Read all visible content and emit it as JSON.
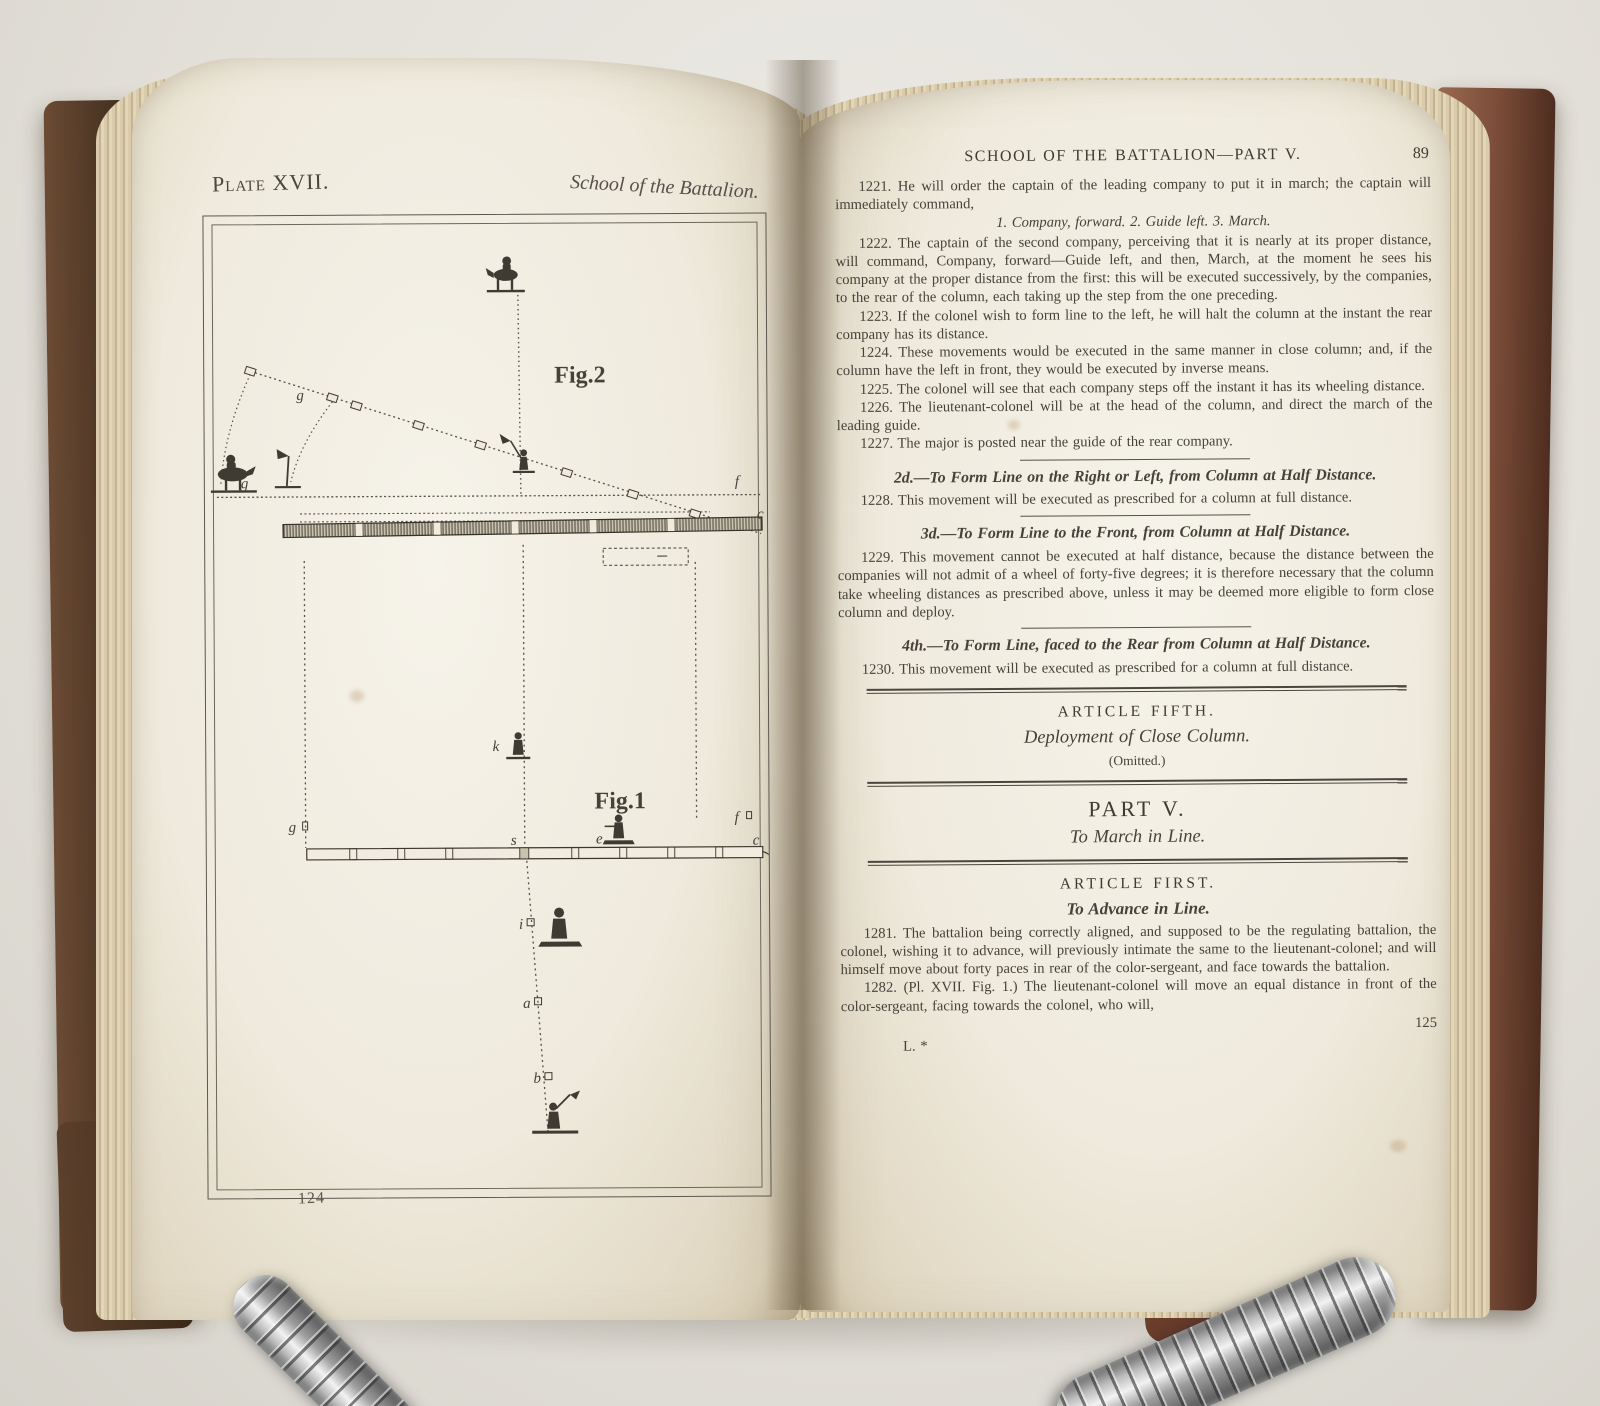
{
  "left_page": {
    "header_left": "Plate XVII.",
    "header_right": "School of the Battalion.",
    "page_number": "124",
    "fig2": {
      "caption": "Fig.2",
      "labels": {
        "g_upper": "g",
        "g_lower": "g",
        "f": "f",
        "c": "c"
      }
    },
    "fig1": {
      "caption": "Fig.1",
      "labels": {
        "k": "k",
        "g": "g",
        "s": "s",
        "e": "e",
        "f": "f",
        "c": "c",
        "i": "i",
        "a": "a",
        "b": "b"
      }
    }
  },
  "right_page": {
    "running_head": "SCHOOL OF THE BATTALION—PART V.",
    "head_page_number": "89",
    "p1221": "1221. He will order the captain of the leading company to put it in march; the captain will immediately command,",
    "commands": "1. Company, forward.  2. Guide left.  3. March.",
    "p1222": "1222. The captain of the second company, perceiving that it is nearly at its proper distance, will command, Company, forward—Guide left, and then, March, at the moment he sees his company at the proper distance from the first: this will be executed successively, by the companies, to the rear of the column, each taking up the step from the one preceding.",
    "p1223": "1223. If the colonel wish to form line to the left, he will halt the column at the instant the rear company has its distance.",
    "p1224": "1224. These movements would be executed in the same manner in close column; and, if the column have the left in front, they would be executed by inverse means.",
    "p1225": "1225. The colonel will see that each company steps off the instant it has its wheeling distance.",
    "p1226": "1226. The lieutenant-colonel will be at the head of the column, and direct the march of the leading guide.",
    "p1227": "1227. The major is posted near the guide of the rear company.",
    "h2d": "2d.—To Form Line on the Right or Left, from Column at Half Distance.",
    "p1228": "1228. This movement will be executed as prescribed for a column at full distance.",
    "h3d": "3d.—To Form Line to the Front, from Column at Half Distance.",
    "p1229": "1229. This movement cannot be executed at half distance, because the distance between the companies will not admit of a wheel of forty-five degrees; it is therefore necessary that the column take wheeling distances as prescribed above, unless it may be deemed more eligible to form close column and deploy.",
    "h4th": "4th.—To Form Line, faced to the Rear from Column at Half Distance.",
    "p1230": "1230. This movement will be executed as prescribed for a column at full distance.",
    "article5_head": "ARTICLE FIFTH.",
    "article5_title": "Deployment of Close Column.",
    "article5_note": "(Omitted.)",
    "part5_head": "PART V.",
    "part5_title": "To March in Line.",
    "article1_head": "ARTICLE FIRST.",
    "article1_title": "To Advance in Line.",
    "p1281": "1281. The battalion being correctly aligned, and supposed to be the regulating battalion, the colonel, wishing it to advance, will previously intimate the same to the lieutenant-colonel; and will himself move about forty paces in rear of the color-sergeant, and face towards the battalion.",
    "p1282": "1282. (Pl. XVII. Fig. 1.) The lieutenant-colonel will move an equal distance in front of the color-sergeant, facing towards the colonel, who will,",
    "page_number": "125",
    "signature_mark": "L. *"
  },
  "colors": {
    "background": "#e4e1da",
    "left_cover": "#4a3423",
    "right_cover": "#7c4d39",
    "paper": "#f2efe6",
    "ink": "#46423a"
  }
}
